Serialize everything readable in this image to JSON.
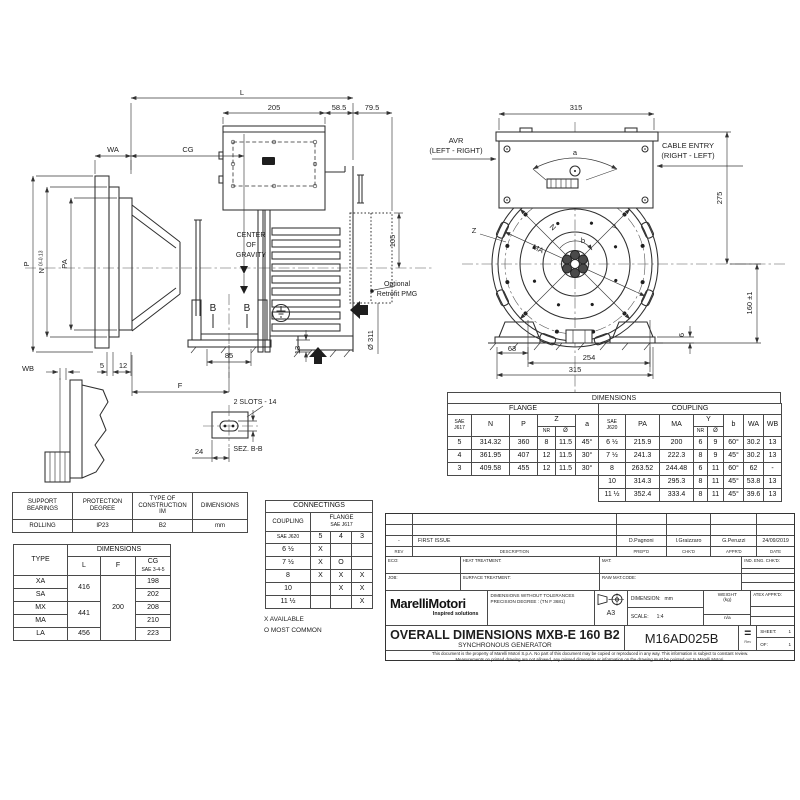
{
  "colors": {
    "line": "#2f2f2f",
    "paper": "#ffffff"
  },
  "side_view": {
    "dims": {
      "L": "L",
      "d205": "205",
      "d585": "58.5",
      "d795": "79.5",
      "WA": "WA",
      "CG": "CG",
      "P": "P",
      "N": "N",
      "N_tol": "0/-0.13",
      "PA": "PA",
      "d105": "105",
      "d85": "85",
      "d13": "13",
      "dia311": "Ø 311",
      "d5": "5",
      "d12": "12",
      "F": "F",
      "WB": "WB",
      "d24": "24"
    },
    "labels": {
      "center1": "CENTER",
      "center2": "OF",
      "center3": "GRAVITY",
      "pmg1": "Optional",
      "pmg2": "Retrofit PMG",
      "slots": "2 SLOTS - 14",
      "section": "SEZ. B-B",
      "B_left": "B",
      "B_right": "B"
    }
  },
  "front_view": {
    "dims": {
      "top315": "315",
      "a": "a",
      "d275": "275",
      "d160": "160 ±1",
      "d6": "6",
      "d63": "63",
      "d254": "254",
      "bottom315": "315"
    },
    "labels": {
      "avr1": "AVR",
      "avr2": "(LEFT - RIGHT)",
      "cable1": "CABLE ENTRY",
      "cable2": "(RIGHT - LEFT)",
      "Z": "Z",
      "N": "N",
      "MA": "MA",
      "Y": "Y",
      "b": "b"
    }
  },
  "dim_table": {
    "title": "DIMENSIONS",
    "flange": {
      "group": "FLANGE",
      "sae1": "SAE",
      "sae2": "J617",
      "hN": "N",
      "hP": "P",
      "hZ": "Z",
      "hNR": "NR",
      "hDia": "Ø",
      "hA": "a",
      "rows": [
        [
          "5",
          "314.32",
          "360",
          "8",
          "11.5",
          "45°"
        ],
        [
          "4",
          "361.95",
          "407",
          "12",
          "11.5",
          "30°"
        ],
        [
          "3",
          "409.58",
          "455",
          "12",
          "11.5",
          "30°"
        ]
      ]
    },
    "coupling": {
      "group": "COUPLING",
      "sae1": "SAE",
      "sae2": "J620",
      "hPA": "PA",
      "hMA": "MA",
      "hY": "Y",
      "hNR": "NR",
      "hDia": "Ø",
      "hB": "b",
      "hWA": "WA",
      "hWB": "WB",
      "rows": [
        [
          "6 ½",
          "215.9",
          "200",
          "6",
          "9",
          "60°",
          "30.2",
          "13"
        ],
        [
          "7 ½",
          "241.3",
          "222.3",
          "8",
          "9",
          "45°",
          "30.2",
          "13"
        ],
        [
          "8",
          "263.52",
          "244.48",
          "6",
          "11",
          "60°",
          "62",
          "-"
        ],
        [
          "10",
          "314.3",
          "295.3",
          "8",
          "11",
          "45°",
          "53.8",
          "13"
        ],
        [
          "11 ½",
          "352.4",
          "333.4",
          "8",
          "11",
          "45°",
          "39.6",
          "13"
        ]
      ]
    }
  },
  "support_table": {
    "headers": [
      "SUPPORT\nBEARINGS",
      "PROTECTION\nDEGREE",
      "TYPE OF\nCONSTRUCTION\nIM",
      "DIMENSIONS"
    ],
    "rows": [
      [
        "ROLLING",
        "IP23",
        "B2",
        "mm"
      ]
    ]
  },
  "type_table": {
    "type_h": "TYPE",
    "dim_h": "DIMENSIONS",
    "col_L": "L",
    "col_F": "F",
    "col_CG": "CG",
    "cg_note": "SAE 3-4-5",
    "rows": [
      [
        "XA",
        {
          "t": "416",
          "rs": 2
        },
        {
          "t": "200",
          "rs": 5
        },
        "198"
      ],
      [
        "SA",
        "202"
      ],
      [
        "MX",
        {
          "t": "441",
          "rs": 2
        },
        "208"
      ],
      [
        "MA",
        "210"
      ],
      [
        "LA",
        "456",
        "223"
      ]
    ]
  },
  "connectings": {
    "title": "CONNECTINGS",
    "coupling_h": "COUPLING",
    "flange_h": "FLANGE",
    "flange_sub": "SAE J617",
    "sae_j620": "SAE J620",
    "cols": [
      "5",
      "4",
      "3"
    ],
    "rows": [
      [
        "6 ½",
        "X",
        "",
        ""
      ],
      [
        "7 ½",
        "X",
        "O",
        ""
      ],
      [
        "8",
        "X",
        "X",
        "X"
      ],
      [
        "10",
        "",
        "X",
        "X"
      ],
      [
        "11 ½",
        "",
        "",
        "X"
      ]
    ],
    "legend1": "X  AVAILABLE",
    "legend2": "O  MOST COMMON"
  },
  "title_block": {
    "rev_row": {
      "rev": "-",
      "desc": "FIRST ISSUE",
      "prep": "D.Pagnoni",
      "chk": "I.Graizzaro",
      "appr": "G.Peruzzi",
      "date": "24/09/2019"
    },
    "cols": {
      "rev": "REV",
      "desc": "DESCRIPTION",
      "prep": "PREP'D",
      "chk": "CHK'D",
      "appr": "APPR'D",
      "date": "DATE"
    },
    "eco": "ECO:",
    "heat": "HEAT TREATMENT:",
    "mat": "MAT:",
    "ind": "IND. ENG. CHK'D:",
    "job": "JOB:",
    "surface": "SURFACE TREATMENT:",
    "raw": "RAW MAT.CODE:",
    "logo": "MarelliMotori",
    "logo_tag": "Inspired solutions",
    "tol1": "DIMENSIONS WITHOUT TOLERANCES",
    "tol2": "PRECISION DEGREE : (TN F 3681)",
    "format": "A3",
    "dim_label": "DIMENSION:",
    "dim_val": "mm",
    "scale_label": "SCALE:",
    "scale_val": "1:4",
    "weight1": "WEIGHT",
    "weight2": "(kg)",
    "weight_val": "n/a",
    "atex": "ATEX APPR'D:",
    "title": "OVERALL DIMENSIONS MXB-E 160 B2",
    "subtitle": "SYNCHRONOUS GENERATOR",
    "code": "M16AD025B",
    "eq": "=",
    "eq_small": "Rev",
    "sheet_label": "SHEET:",
    "sheet_val": "1",
    "of_label": "OF:",
    "of_val": "1",
    "disclaimer1": "This document is the property of Marelli Motori S.p.A. No part of this document may be copied or reproduced in any way. This information is subject to constant review.",
    "disclaimer2": "Measurements on printed drawing are not allowed, any missed dimension or information on the drawing must be pointed out to Marelli Motori."
  }
}
